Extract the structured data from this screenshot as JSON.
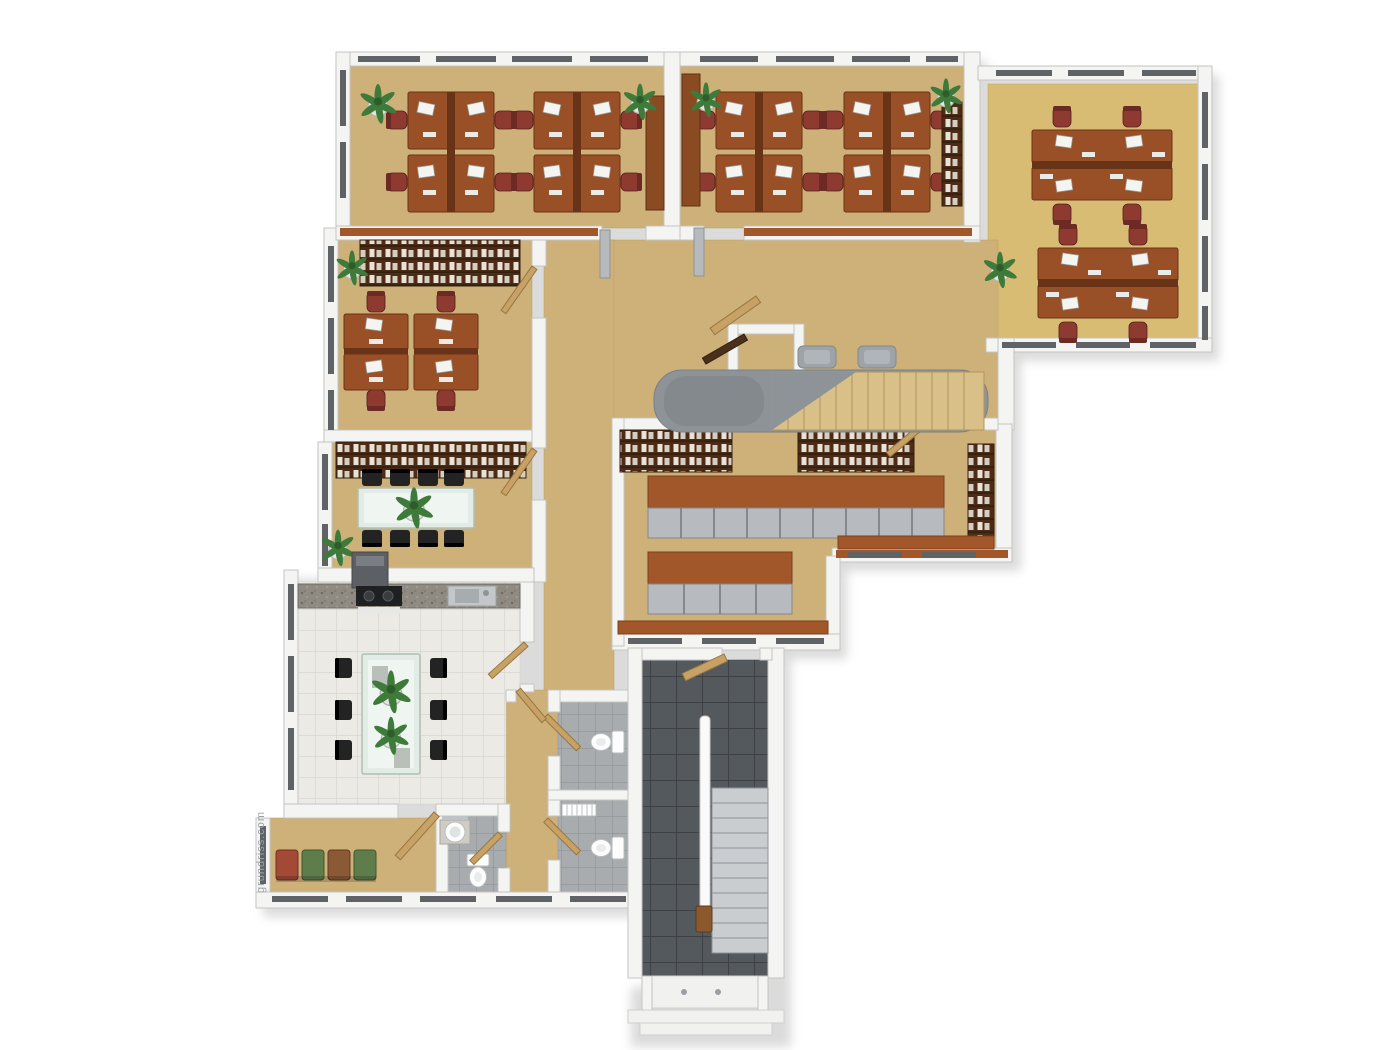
{
  "meta": {
    "title": "3D rendered office floor plan, top-down view",
    "watermark": "grundriss.com"
  },
  "colors": {
    "wall": "#f4f4f3",
    "wall_edge": "#c4c4c2",
    "wood_floor": "#cdb179",
    "wood_floor_edge": "#b99e63",
    "carpet_tan": "#d9bc74",
    "desk_brown": "#9a5027",
    "desk_dark": "#693317",
    "chair_red": "#8e3a30",
    "chair_black": "#232323",
    "cabinet_top": "#a2572a",
    "cabinet_door": "#b7bbbf",
    "glass": "#e2ebe6",
    "plant_green": "#3e7a39",
    "door_wood": "#c7a166",
    "window_slot": "#606365",
    "stair_wood": "#d9c089",
    "stair_void": "#8e9397",
    "steps_gray": "#c9cdd0",
    "partition_gray": "#b6babd",
    "watermark": "#9aa2a8"
  },
  "plan": {
    "view": "single office storey seen from above",
    "rooms": [
      {
        "name": "open-office-northwest",
        "floor": "light wood",
        "contents": "2 quad desk clusters (8 workstations), monitors, red office chairs, 2 plants, tall cabinet"
      },
      {
        "name": "open-office-north",
        "floor": "light wood",
        "contents": "2 quad desk clusters (8 workstations), tall cabinet, wall bookshelf, 2 plants"
      },
      {
        "name": "open-office-east-wing",
        "floor": "tan carpet",
        "contents": "2 double desk groups (4 workstations), red chairs, plant at entry"
      },
      {
        "name": "office-west",
        "floor": "light wood",
        "contents": "long wall shelving with binders, 2 double desks (4 workstations), corner plant, open door"
      },
      {
        "name": "meeting-room",
        "floor": "light wood",
        "contents": "wall shelving, glass conference table, 8 black chairs, table plant, corner plant"
      },
      {
        "name": "kitchen-break-room",
        "floor": "white tile",
        "contents": "counter with cooktop, extractor hood and sink, glass dining table, 6 black chairs, 2 table plants"
      },
      {
        "name": "archive-room",
        "floor": "light wood",
        "contents": "wall bookshelves, 2 freestanding cabinet rows with gray doors, low sideboards, entry door"
      },
      {
        "name": "central-corridor",
        "floor": "light wood",
        "contents": "interior staircase with curved gray parapet, 2 gray benches, small closet with dark door, gray partitions, open doors, plant"
      },
      {
        "name": "hallway-southwest",
        "floor": "light wood",
        "contents": "4 waiting chairs (red, green, brown, green), open door"
      },
      {
        "name": "washroom",
        "floor": "gray tile",
        "contents": "round basin on counter, mirror, toilet, door"
      },
      {
        "name": "wc-stalls",
        "floor": "gray tile",
        "contents": "2 toilets, radiator, 2 doors"
      },
      {
        "name": "main-stairwell",
        "floor": "dark gray tile",
        "contents": "straight stair flight, white handrail wall, wooden post, entrance vestibule with outside steps"
      }
    ]
  }
}
